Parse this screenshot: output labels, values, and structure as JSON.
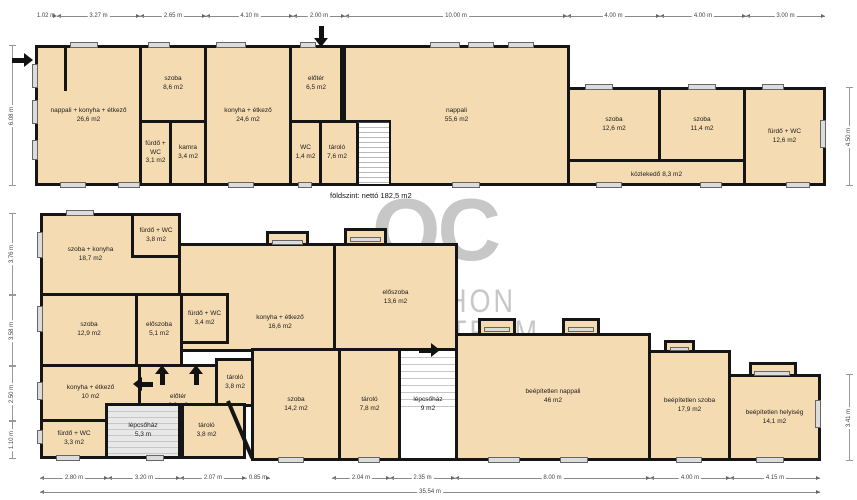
{
  "caption": "földszint: nettó 182,5 m2",
  "watermark": {
    "logo": "OC",
    "line1": "OTTHON",
    "line2": "CENTRUM"
  },
  "colors": {
    "room_fill": "#f4dbb1",
    "wall": "#151515",
    "stairs_gray": "#d8d8d8",
    "watermark_gray": "#c7c7c7"
  },
  "floors": {
    "ground": {
      "rooms": [
        {
          "name": "nappali + konyha + étkező",
          "area": "26,6 m2"
        },
        {
          "name": "szoba",
          "area": "8,6 m2"
        },
        {
          "name": "fürdő + WC",
          "area": "3,1 m2"
        },
        {
          "name": "kamra",
          "area": "3,4 m2"
        },
        {
          "name": "konyha + étkező",
          "area": "24,6 m2"
        },
        {
          "name": "nappali",
          "area": "55,6 m2"
        },
        {
          "name": "előtér",
          "area": "6,5 m2"
        },
        {
          "name": "WC",
          "area": "1,4 m2"
        },
        {
          "name": "tároló",
          "area": "7,6 m2"
        },
        {
          "name": "szoba",
          "area": "12,6 m2"
        },
        {
          "name": "szoba",
          "area": "11,4 m2"
        },
        {
          "name": "fürdő + WC",
          "area": "12,6 m2"
        },
        {
          "name": "közlekedő",
          "area": "8,3 m2"
        }
      ]
    },
    "upper": {
      "rooms": [
        {
          "name": "konyha + étkező",
          "area": "16,6 m2"
        },
        {
          "name": "szoba + konyha",
          "area": "18,7 m2"
        },
        {
          "name": "fürdő + WC",
          "area": "3,8 m2"
        },
        {
          "name": "szoba",
          "area": "12,9 m2"
        },
        {
          "name": "előszoba",
          "area": "5,1 m2"
        },
        {
          "name": "fürdő + WC",
          "area": "3,4 m2"
        },
        {
          "name": "előszoba",
          "area": "13,6 m2"
        },
        {
          "name": "konyha + étkező",
          "area": "10 m2"
        },
        {
          "name": "előtér",
          "area": "6,9 m2"
        },
        {
          "name": "tároló",
          "area": "3,8 m2"
        },
        {
          "name": "lépcsőház",
          "area": "5,3 m"
        },
        {
          "name": "fürdő + WC",
          "area": "3,3 m2"
        },
        {
          "name": "tároló",
          "area": "3,8 m2"
        },
        {
          "name": "szoba",
          "area": "14,2 m2"
        },
        {
          "name": "tároló",
          "area": "7,8 m2"
        },
        {
          "name": "lépcsőház",
          "area": "9 m2"
        },
        {
          "name": "beépítetlen nappali",
          "area": "46 m2"
        },
        {
          "name": "beépítetlen szoba",
          "area": "17,9 m2"
        },
        {
          "name": "beépítetlen helyiség",
          "area": "14,1 m2"
        }
      ]
    }
  },
  "dims": {
    "top": [
      "1.02 m",
      "3.27 m",
      "2.65 m",
      "4.10 m",
      "2.00 m",
      "10.00 m",
      "4.00 m",
      "4.00 m",
      "3.00 m"
    ],
    "bottom": [
      "2.80 m",
      "3.20 m",
      "2.07 m",
      "0.85 m",
      "2.04 m",
      "2.35 m",
      "8.00 m",
      "4.00 m",
      "4.15 m"
    ],
    "total": "35.54 m",
    "left_ground": "6.08 m",
    "left_upper": [
      "3.76 m",
      "3.58 m",
      "2.50 m",
      "1.10 m"
    ],
    "right_ground": "4.50 m",
    "right_upper": "3.41 m"
  }
}
